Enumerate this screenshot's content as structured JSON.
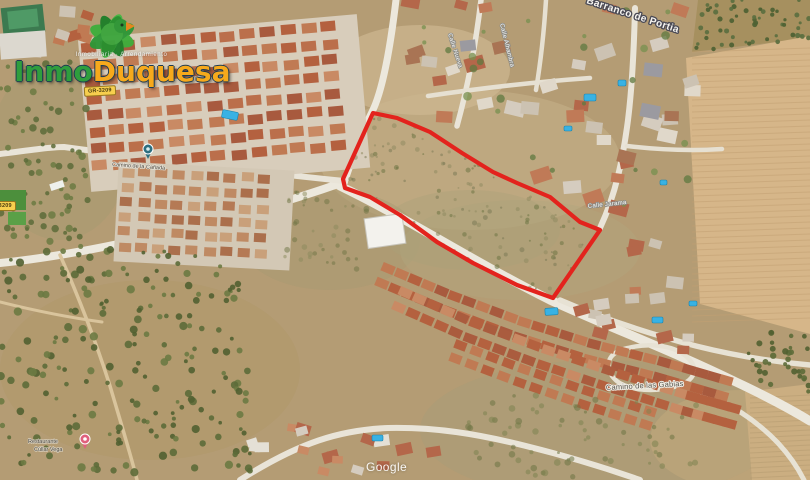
{
  "page": {
    "width": 810,
    "height": 480,
    "description": "Aerial satellite photo of a building plot for sale outlined in red, Cullar Vega area"
  },
  "branding": {
    "tagline": "Inmobiliaria · Arrendamiento",
    "name_part1": "Inmo",
    "name_part2": "Duquesa",
    "green": "#2f9e3d",
    "orange": "#f6a91c"
  },
  "watermark": {
    "text": "Google"
  },
  "road_badges": [
    {
      "text": "GR-3209"
    },
    {
      "text": "GR-3209"
    }
  ],
  "parcel": {
    "stroke": "#e3231d",
    "stroke_width": 4.2,
    "points": [
      [
        373,
        113
      ],
      [
        397,
        118
      ],
      [
        430,
        132
      ],
      [
        462,
        153
      ],
      [
        493,
        172
      ],
      [
        517,
        183
      ],
      [
        550,
        197
      ],
      [
        580,
        222
      ],
      [
        600,
        230
      ],
      [
        553,
        298
      ],
      [
        517,
        285
      ],
      [
        473,
        263
      ],
      [
        437,
        242
      ],
      [
        400,
        215
      ],
      [
        370,
        197
      ],
      [
        345,
        188
      ],
      [
        343,
        179
      ]
    ]
  },
  "labels": [
    {
      "text": "Barranco de Portia",
      "x": 586,
      "y": 3,
      "rot": 18,
      "size": 10,
      "fill": "#f7f5f0",
      "halo": "#4a4a55",
      "hw": 2.6,
      "weight": "bold",
      "ls": 0.4
    },
    {
      "text": "Camino de las Gabias",
      "x": 606,
      "y": 390,
      "rot": -3,
      "size": 7.5,
      "fill": "#55524a",
      "halo": "#efece4",
      "hw": 2,
      "weight": "normal",
      "ls": 0.2
    },
    {
      "text": "Camino de la Cañada",
      "x": 112,
      "y": 166,
      "rot": 4,
      "size": 5.5,
      "fill": "#4e483e",
      "halo": "#e8e4da",
      "hw": 1.4,
      "weight": "normal",
      "ls": 0
    },
    {
      "text": "Restaurante",
      "x": 28,
      "y": 443,
      "rot": 0,
      "size": 5.5,
      "fill": "#443f36",
      "halo": "#ded8ca",
      "hw": 1.2,
      "weight": "normal",
      "ls": 0
    },
    {
      "text": "Cúllar Vega",
      "x": 34,
      "y": 451,
      "rot": 0,
      "size": 5.5,
      "fill": "#443f36",
      "halo": "#ded8ca",
      "hw": 1.2,
      "weight": "normal",
      "ls": 0
    },
    {
      "text": "Calle Nueva",
      "x": 448,
      "y": 34,
      "rot": 72,
      "size": 6,
      "fill": "#fdfdfb",
      "halo": "#8a8a85",
      "hw": 1.6,
      "weight": "normal",
      "ls": 0.3
    },
    {
      "text": "Calle Alhambra",
      "x": 500,
      "y": 24,
      "rot": 76,
      "size": 6,
      "fill": "#fdfdfb",
      "halo": "#8a8a85",
      "hw": 1.6,
      "weight": "normal",
      "ls": 0.3
    },
    {
      "text": "Calle Jarama",
      "x": 588,
      "y": 208,
      "rot": -6,
      "size": 6,
      "fill": "#fdfdfb",
      "halo": "#8a8a85",
      "hw": 1.6,
      "weight": "normal",
      "ls": 0.3
    }
  ],
  "pins": [
    {
      "kind": "place-pin",
      "x": 148,
      "y": 149,
      "c1": "#2d6f80",
      "c2": "#d8edef"
    },
    {
      "kind": "restaurant-pin",
      "x": 85,
      "y": 439,
      "c1": "#e0607c",
      "c2": "#ffffff"
    }
  ],
  "map": {
    "base": "#b49c74",
    "patches": [
      {
        "cx": 470,
        "cy": 160,
        "rx": 150,
        "ry": 70,
        "fill": "#c6b28a",
        "a": 0.55
      },
      {
        "cx": 420,
        "cy": 70,
        "rx": 90,
        "ry": 45,
        "fill": "#cdb891",
        "a": 0.7
      },
      {
        "cx": 330,
        "cy": 240,
        "rx": 90,
        "ry": 50,
        "fill": "#a89a72",
        "a": 0.5
      },
      {
        "cx": 600,
        "cy": 430,
        "rx": 180,
        "ry": 70,
        "fill": "#a79c77",
        "a": 0.5
      },
      {
        "cx": 150,
        "cy": 370,
        "rx": 150,
        "ry": 90,
        "fill": "#b09868",
        "a": 0.5
      },
      {
        "cx": 520,
        "cy": 250,
        "rx": 120,
        "ry": 50,
        "fill": "#b2a67e",
        "a": 0.45
      },
      {
        "cx": 60,
        "cy": 150,
        "rx": 70,
        "ry": 90,
        "fill": "#a39b70",
        "a": 0.45
      },
      {
        "cx": 740,
        "cy": 440,
        "rx": 90,
        "ry": 50,
        "fill": "#c3a97c",
        "a": 0.5
      },
      {
        "cx": 470,
        "cy": 230,
        "rx": 90,
        "ry": 40,
        "fill": "#ab9f78",
        "a": 0.4
      }
    ],
    "orchard_base": [
      {
        "poly": [
          [
            698,
            0
          ],
          [
            810,
            0
          ],
          [
            810,
            38
          ],
          [
            692,
            52
          ]
        ],
        "fill": "#a6905f"
      }
    ],
    "fields": [
      {
        "poly": [
          [
            686,
            58
          ],
          [
            810,
            36
          ],
          [
            810,
            334
          ],
          [
            700,
            304
          ]
        ],
        "fill": "#d6b689"
      },
      {
        "poly": [
          [
            745,
            392
          ],
          [
            810,
            384
          ],
          [
            810,
            480
          ],
          [
            752,
            480
          ]
        ],
        "fill": "#cbae81"
      }
    ],
    "field_rows": [
      {
        "x1": 692,
        "x2": 810,
        "y0": 52,
        "y1": 326,
        "step": 6,
        "slope": -4,
        "color": "#c2a173",
        "a": 0.55,
        "w": 1
      },
      {
        "x1": 750,
        "x2": 810,
        "y0": 398,
        "y1": 478,
        "step": 5,
        "slope": -3,
        "color": "#b49a6f",
        "a": 0.5,
        "w": 1
      }
    ],
    "roads": [
      {
        "d": "M 0,263 C 90,254 230,222 344,182",
        "w": 8,
        "c": "#ece8dd"
      },
      {
        "d": "M 340,186 C 414,222 474,262 550,300 C 616,330 670,350 736,382 C 772,399 792,410 810,421",
        "w": 9,
        "c": "#ece8dd"
      },
      {
        "d": "M 345,180 C 356,148 362,132 372,112 C 383,90 391,42 396,0",
        "w": 7,
        "c": "#ece8dd"
      },
      {
        "d": "M 0,154 C 30,150 52,147 64,147 C 160,160 255,172 344,181",
        "w": 6,
        "c": "#e9e4d8"
      },
      {
        "d": "M 92,58 C 170,72 270,80 356,74",
        "w": 4.5,
        "c": "#e6e0d2"
      },
      {
        "d": "M 481,0 C 476,42 468,86 457,126",
        "w": 5.5,
        "c": "#e9e4d8"
      },
      {
        "d": "M 546,0 C 544,32 541,60 536,90",
        "w": 4.5,
        "c": "#e6e0d2"
      },
      {
        "d": "M 428,96 C 482,88 534,82 590,78",
        "w": 4.5,
        "c": "#e6e0d2"
      },
      {
        "d": "M 600,228 C 616,194 623,158 628,120 C 632,88 634,48 635,8",
        "w": 6,
        "c": "#e9e4d8"
      },
      {
        "d": "M 627,146 C 660,150 692,151 722,149",
        "w": 4.5,
        "c": "#e6e0d2"
      },
      {
        "d": "M 560,300 C 606,320 650,334 696,346 C 736,356 776,362 810,365",
        "w": 5.5,
        "c": "#e7e2d4"
      },
      {
        "d": "M 612,376 C 604,362 610,352 628,348 C 652,342 676,346 688,358 C 700,370 694,382 674,387 C 650,393 622,390 612,376",
        "w": 4.5,
        "c": "#e7e2d4"
      },
      {
        "d": "M 240,480 C 300,442 340,430 388,428 C 436,427 478,434 526,446 C 566,456 606,468 640,480",
        "w": 6,
        "c": "#e9e4d8"
      },
      {
        "d": "M 700,392 C 728,402 756,420 778,443 C 790,456 798,468 804,480",
        "w": 5,
        "c": "#e7e2d4"
      },
      {
        "d": "M 60,255 C 80,300 96,342 110,386 C 120,420 130,452 137,480",
        "w": 3.5,
        "c": "#d9c49c"
      },
      {
        "d": "M 0,302 C 40,312 72,318 102,322",
        "w": 3,
        "c": "#d9c49c"
      }
    ],
    "housing": [
      {
        "type": "grid",
        "x": 88,
        "y": 30,
        "w": 272,
        "h": 146,
        "rot": -5,
        "dx": 20,
        "dy": 17,
        "hw": 15,
        "hh": 10,
        "base": "#d8cdbb",
        "colors": [
          "#b4613f",
          "#c07a53",
          "#a85a3e",
          "#c98a64",
          "#bb6f4b"
        ],
        "seed": 7
      },
      {
        "type": "grid",
        "x": 120,
        "y": 170,
        "w": 168,
        "h": 92,
        "rot": 3,
        "dx": 17,
        "dy": 15,
        "hw": 12,
        "hh": 9,
        "base": "#d3c8b5",
        "colors": [
          "#b57a55",
          "#c9a07a",
          "#ab6f4c",
          "#bf8a63"
        ],
        "seed": 11
      },
      {
        "type": "scatter",
        "poly": [
          [
            398,
            0
          ],
          [
            696,
            0
          ],
          [
            692,
            212
          ],
          [
            600,
            224
          ],
          [
            545,
            196
          ],
          [
            498,
            168
          ],
          [
            452,
            134
          ],
          [
            420,
            96
          ],
          [
            404,
            48
          ]
        ],
        "n": 40,
        "smin": 12,
        "smax": 20,
        "colors": [
          "#c07a57",
          "#d5ccbf",
          "#b4674a",
          "#ccc2b2",
          "#a97454",
          "#9b9aa0",
          "#e0d8ca"
        ],
        "seed": 21
      },
      {
        "type": "strip",
        "pts": [
          [
            385,
            276
          ],
          [
            452,
            304
          ],
          [
            522,
            330
          ],
          [
            592,
            352
          ],
          [
            662,
            370
          ],
          [
            724,
            388
          ]
        ],
        "n": 26,
        "off": 8,
        "hw": 13,
        "hh": 9,
        "colors": [
          "#b4613f",
          "#c07a53",
          "#a85a3e"
        ],
        "seed": 31
      },
      {
        "type": "strip",
        "pts": [
          [
            402,
            300
          ],
          [
            470,
            330
          ],
          [
            540,
            356
          ],
          [
            612,
            380
          ],
          [
            682,
            402
          ],
          [
            732,
            416
          ]
        ],
        "n": 25,
        "off": 8,
        "hw": 13,
        "hh": 9,
        "colors": [
          "#b4613f",
          "#c98a64",
          "#aa5c3e"
        ],
        "seed": 32
      },
      {
        "type": "strip",
        "pts": [
          [
            458,
            352
          ],
          [
            522,
            376
          ],
          [
            586,
            398
          ],
          [
            648,
            418
          ]
        ],
        "n": 13,
        "off": 7,
        "hw": 12,
        "hh": 9,
        "colors": [
          "#b4613f",
          "#c07a53"
        ],
        "seed": 33
      },
      {
        "type": "scatter",
        "poly": [
          [
            604,
            236
          ],
          [
            700,
            246
          ],
          [
            706,
            352
          ],
          [
            612,
            348
          ],
          [
            562,
            312
          ],
          [
            558,
            298
          ]
        ],
        "n": 16,
        "smin": 11,
        "smax": 17,
        "colors": [
          "#c07a57",
          "#d5ccbf",
          "#b4674a",
          "#ccc2b2"
        ],
        "seed": 41
      },
      {
        "type": "scatter",
        "poly": [
          [
            244,
            418
          ],
          [
            330,
            402
          ],
          [
            424,
            416
          ],
          [
            462,
            444
          ],
          [
            430,
            470
          ],
          [
            340,
            478
          ],
          [
            258,
            472
          ],
          [
            238,
            446
          ]
        ],
        "n": 17,
        "smin": 10,
        "smax": 16,
        "colors": [
          "#c98a64",
          "#d5ccbf",
          "#b4674a",
          "#e4e0d6"
        ],
        "seed": 51
      },
      {
        "type": "scatter",
        "poly": [
          [
            0,
            0
          ],
          [
            92,
            0
          ],
          [
            92,
            58
          ],
          [
            0,
            58
          ]
        ],
        "n": 9,
        "smin": 11,
        "smax": 16,
        "colors": [
          "#b4613f",
          "#c07a53",
          "#cdc3b3"
        ],
        "seed": 61
      }
    ],
    "trees": [
      {
        "poly": [
          [
            0,
            246
          ],
          [
            238,
            252
          ],
          [
            258,
            480
          ],
          [
            0,
            480
          ]
        ],
        "n": 210,
        "rmin": 1.8,
        "rmax": 4.2,
        "colors": [
          "#5c6b38",
          "#6b7a42",
          "#516131"
        ],
        "a": 0.9,
        "seed": 71
      },
      {
        "poly": [
          [
            0,
            58
          ],
          [
            86,
            62
          ],
          [
            90,
            248
          ],
          [
            0,
            246
          ]
        ],
        "n": 80,
        "rmin": 1.8,
        "rmax": 3.8,
        "colors": [
          "#5c6b38",
          "#6b7a42"
        ],
        "a": 0.85,
        "seed": 72
      },
      {
        "poly": [
          [
            698,
            0
          ],
          [
            810,
            0
          ],
          [
            810,
            38
          ],
          [
            692,
            52
          ]
        ],
        "n": 55,
        "rmin": 1.4,
        "rmax": 2.6,
        "colors": [
          "#4f6234",
          "#5d7040"
        ],
        "a": 0.95,
        "seed": 73
      },
      {
        "poly": [
          [
            746,
            330
          ],
          [
            810,
            332
          ],
          [
            810,
            392
          ],
          [
            752,
            390
          ]
        ],
        "n": 34,
        "rmin": 1.6,
        "rmax": 3.2,
        "colors": [
          "#5c6b38",
          "#516131"
        ],
        "a": 0.9,
        "seed": 74
      },
      {
        "poly": [
          [
            462,
            392
          ],
          [
            700,
            402
          ],
          [
            696,
            480
          ],
          [
            468,
            480
          ]
        ],
        "n": 70,
        "rmin": 1.4,
        "rmax": 3.4,
        "colors": [
          "#6e7444",
          "#7d8350"
        ],
        "a": 0.55,
        "seed": 75
      },
      {
        "poly": [
          [
            290,
            185
          ],
          [
            372,
            208
          ],
          [
            360,
            270
          ],
          [
            282,
            262
          ]
        ],
        "n": 40,
        "rmin": 1.2,
        "rmax": 3,
        "colors": [
          "#6e7444",
          "#8a8a5c"
        ],
        "a": 0.5,
        "seed": 76
      },
      {
        "poly": [
          [
            398,
            10
          ],
          [
            690,
            6
          ],
          [
            688,
            208
          ],
          [
            602,
            220
          ],
          [
            500,
            166
          ],
          [
            424,
            92
          ]
        ],
        "n": 26,
        "rmin": 2,
        "rmax": 4.5,
        "colors": [
          "#77904f",
          "#5f7a40"
        ],
        "a": 0.75,
        "seed": 22
      },
      {
        "poly": "parcel",
        "n": 130,
        "rmin": 0.9,
        "rmax": 2.6,
        "colors": [
          "#8f8a60",
          "#7c7a55",
          "#6e7444"
        ],
        "a": 0.55,
        "seed": 77
      }
    ],
    "pools": [
      [
        222,
        111,
        16,
        8,
        12
      ],
      [
        584,
        94,
        12,
        7,
        0
      ],
      [
        618,
        80,
        8,
        6,
        0
      ],
      [
        564,
        126,
        8,
        5,
        0
      ],
      [
        660,
        180,
        7,
        5,
        0
      ],
      [
        545,
        308,
        13,
        7,
        -4
      ],
      [
        652,
        317,
        11,
        6,
        0
      ],
      [
        689,
        301,
        8,
        5,
        0
      ],
      [
        372,
        435,
        11,
        6,
        0
      ]
    ],
    "pool_fill": "#38b2e4",
    "pool_stroke": "#1b84ad",
    "white_building": {
      "x": 366,
      "y": 216,
      "w": 38,
      "h": 30,
      "rot": -8,
      "fill": "#f3f2ed",
      "stroke": "#c7c4ba"
    },
    "extra_rects": [
      {
        "x": 2,
        "y": 6,
        "w": 42,
        "h": 28,
        "rot": -6,
        "fill": "#3c7a50"
      },
      {
        "x": 8,
        "y": 10,
        "w": 30,
        "h": 18,
        "rot": -6,
        "fill": "#4f9a66"
      },
      {
        "x": 0,
        "y": 32,
        "w": 46,
        "h": 26,
        "rot": -4,
        "fill": "#dcd8cf"
      },
      {
        "x": 0,
        "y": 190,
        "w": 26,
        "h": 20,
        "rot": 0,
        "fill": "#4c8f3c"
      },
      {
        "x": 8,
        "y": 212,
        "w": 18,
        "h": 13,
        "rot": 0,
        "fill": "#5aa047"
      },
      {
        "x": 50,
        "y": 182,
        "w": 14,
        "h": 7,
        "rot": -18,
        "fill": "#eef0ec"
      }
    ]
  }
}
